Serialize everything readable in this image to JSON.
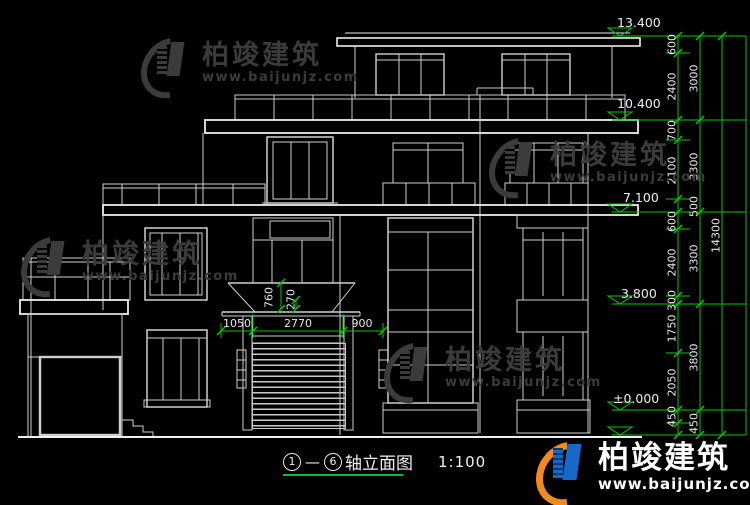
{
  "title": {
    "axis_start": "1",
    "axis_end": "6",
    "dash": "—",
    "label": "轴立面图",
    "scale": "1:100"
  },
  "watermark": {
    "brand": "柏竣建筑",
    "url": "www.baijunjz.com"
  },
  "footer_logo": {
    "brand": "柏竣建筑",
    "url": "www.baijunjz.com"
  },
  "elevations": [
    "13.400",
    "10.400",
    "7.100",
    "3.800",
    "±0.000"
  ],
  "dims": {
    "col1": [
      "600",
      "2400",
      "700",
      "2100",
      "500",
      "600",
      "2400",
      "300",
      "1750",
      "2050",
      "450",
      "450"
    ],
    "col2": [
      "3000",
      "3300",
      "3300",
      "3800"
    ],
    "col3": [
      "14300"
    ],
    "entrance": {
      "left": "1050",
      "middle": "2770",
      "right": "900",
      "canopy_height": "760",
      "canopy_edge": "270"
    }
  },
  "colors": {
    "background": "#000000",
    "line": "#d0d0d0",
    "slab": "#eeeeee",
    "dimension": "#00c800",
    "watermark": "#3b3b3b",
    "logo_blue": "#1669c9",
    "logo_orange": "#f28a1d"
  }
}
